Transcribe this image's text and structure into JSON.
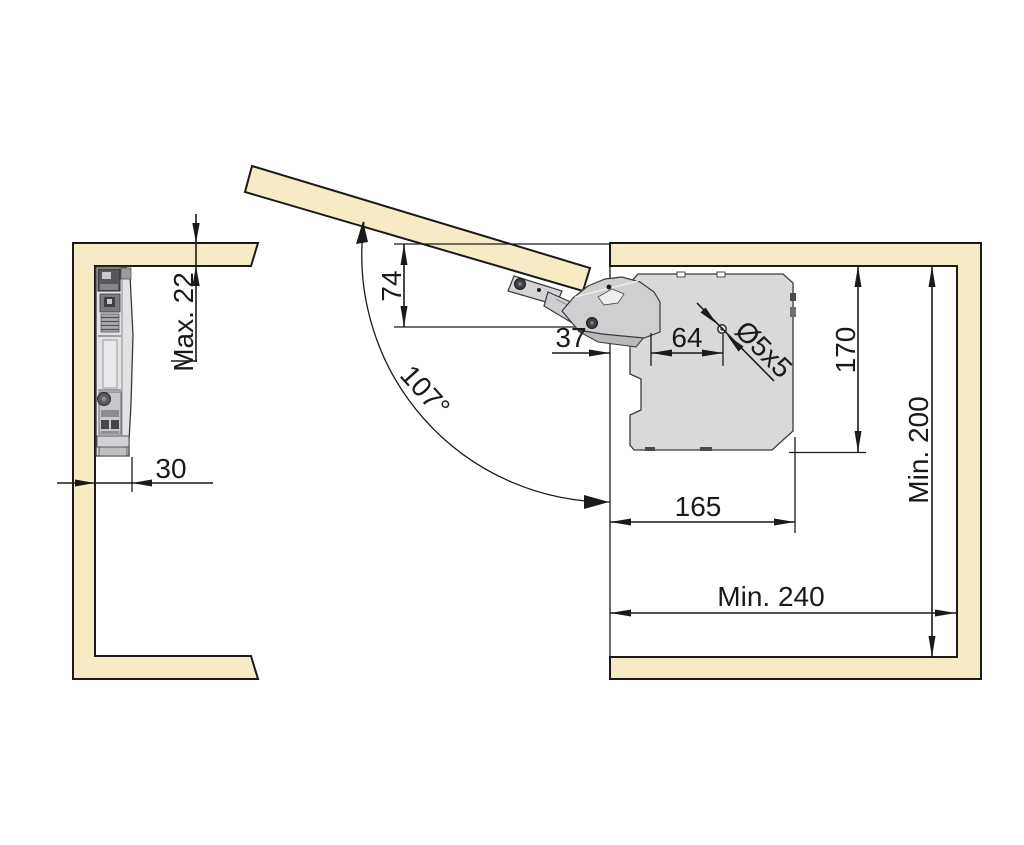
{
  "dimensions": {
    "max_door_thickness": "Max. 22",
    "mechanism_depth": "30",
    "arm_drop": "74",
    "opening_angle": "107°",
    "front_to_first_hole": "37",
    "hole_spacing": "64",
    "screw_spec": "Ø5x5",
    "plate_height": "170",
    "min_interior_height": "Min. 200",
    "plate_depth": "165",
    "min_interior_depth": "Min. 240"
  },
  "colors": {
    "background": "#FFFFFF",
    "wood": "#F7EBC6",
    "outline": "#1A1A1A",
    "metal_light": "#D9D9DB",
    "metal_mid": "#9A9A9E",
    "metal_dark": "#4A4A4E"
  }
}
